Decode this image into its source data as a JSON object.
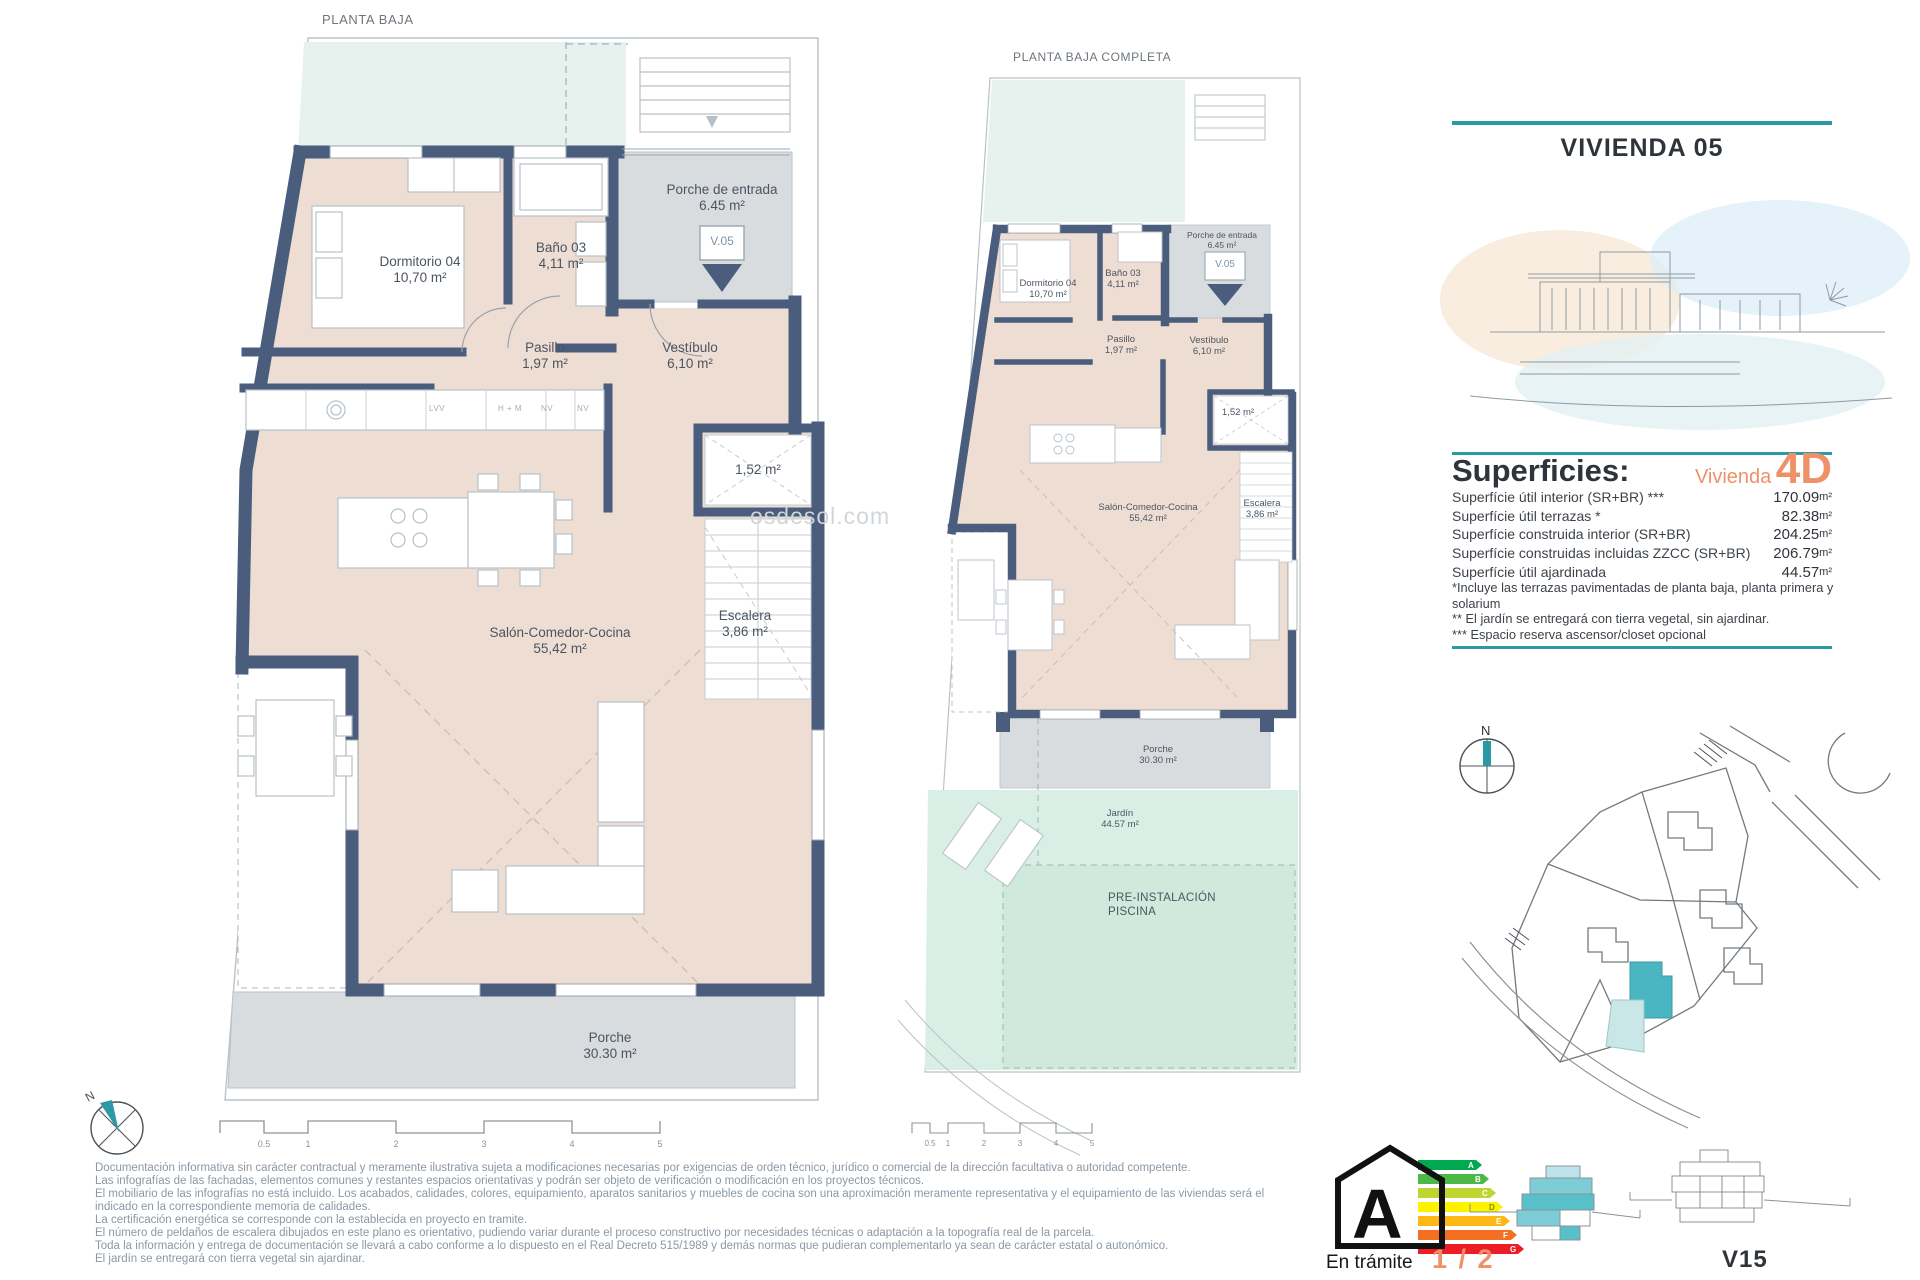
{
  "theme": {
    "accent_teal": "#2b9aa5",
    "accent_orange": "#ef9068",
    "wall": "#4a5d7d",
    "floor": "#eeddd3",
    "terrace": "#e7f2ee",
    "porch": "#d9dcdf",
    "garden": "#d9efe5",
    "garden_deep": "#cfe9dc",
    "line": "#9aa5ad",
    "label": "#4b5560",
    "map_teal": "#49b6c2",
    "map_teal_light": "#c8e7e6"
  },
  "watermark": "osdesol.com",
  "plan_main": {
    "title": "PLANTA BAJA",
    "unit_marker": "V.05",
    "labels": {
      "dormitorio": {
        "name": "Dormitorio 04",
        "area": "10,70 m²"
      },
      "bano": {
        "name": "Baño 03",
        "area": "4,11 m²"
      },
      "porche_entrada": {
        "name": "Porche de entrada",
        "area": "6.45 m²"
      },
      "pasillo": {
        "name": "Pasillo",
        "area": "1,97 m²"
      },
      "vestibulo": {
        "name": "Vestíbulo",
        "area": "6,10 m²"
      },
      "trastero": {
        "area": "1,52 m²"
      },
      "salon": {
        "name": "Salón-Comedor-Cocina",
        "area": "55,42 m²"
      },
      "escalera": {
        "name": "Escalera",
        "area": "3,86 m²"
      },
      "porche": {
        "name": "Porche",
        "area": "30.30 m²"
      }
    },
    "kitchen_labels": [
      "LVV",
      "H + M",
      "NV",
      "NV"
    ]
  },
  "plan_complete": {
    "title": "PLANTA BAJA COMPLETA",
    "unit_marker": "V.05",
    "labels": {
      "dormitorio": {
        "name": "Dormitorio 04",
        "area": "10,70 m²"
      },
      "bano": {
        "name": "Baño 03",
        "area": "4,11 m²"
      },
      "porche_entrada": {
        "name": "Porche de entrada",
        "area": "6.45 m²"
      },
      "pasillo": {
        "name": "Pasillo",
        "area": "1,97 m²"
      },
      "vestibulo": {
        "name": "Vestíbulo",
        "area": "6,10 m²"
      },
      "trastero": {
        "area": "1,52 m²"
      },
      "salon": {
        "name": "Salón-Comedor-Cocina",
        "area": "55,42 m²"
      },
      "escalera": {
        "name": "Escalera",
        "area": "3,86 m²"
      },
      "porche": {
        "name": "Porche",
        "area": "30.30 m²"
      },
      "jardin": {
        "name": "Jardín",
        "area": "44.57 m²"
      },
      "pre_instalacion": {
        "line1": "PRE-INSTALACIÓN",
        "line2": "PISCINA"
      }
    }
  },
  "panel": {
    "title": "VIVIENDA 05",
    "superficies": {
      "heading": "Superficies:",
      "variant_label": "Vivienda",
      "variant_code": "4D",
      "rows": [
        {
          "label": "Superfície útil interior (SR+BR) ***",
          "value": "170.09",
          "unit": "m²"
        },
        {
          "label": "Superfície útil terrazas *",
          "value": "82.38",
          "unit": "m²"
        },
        {
          "label": "Superfície construida interior (SR+BR)",
          "value": "204.25",
          "unit": "m²"
        },
        {
          "label": "Superfície construidas incluidas ZZCC (SR+BR)",
          "value": "206.79",
          "unit": "m²"
        },
        {
          "label": "Superfície útil ajardinada",
          "value": "44.57",
          "unit": "m²"
        }
      ],
      "footnotes": [
        "*Incluye las terrazas pavimentadas de planta baja, planta primera y solarium",
        "** El jardín se entregará con tierra vegetal, sin ajardinar.",
        "*** Espacio reserva ascensor/closet opcional"
      ]
    }
  },
  "site_map": {
    "north_label": "N"
  },
  "footer": {
    "compass_north": "N",
    "scale_ticks": [
      "0.5",
      "1",
      "2",
      "3",
      "4",
      "5"
    ],
    "disclaimer": [
      "Documentación informativa sin carácter contractual y meramente ilustrativa sujeta a modificaciones necesarias por exigencias de orden técnico, jurídico o comercial de la dirección facultativa o autoridad competente.",
      "Las infografías de las fachadas, elementos comunes y restantes espacios orientativas y podrán ser objeto de verificación o modificación en los proyectos técnicos.",
      "El mobiliario de las infografías no está incluido. Los acabados, calidades, colores, equipamiento, aparatos sanitarios y muebles de cocina son una aproximación meramente representativa y el equipamiento de las viviendas será el",
      "indicado en la correspondiente memoria de calidades.",
      "La certificación energética se corresponde con la establecida en proyecto en tramite.",
      "El número de peldaños de escalera dibujados en este plano es orientativo, pudiendo variar durante el proceso constructivo por necesidades técnicas o adaptación a la topografía real de la parcela.",
      "Toda la información y entrega de documentación se llevará a cabo conforme a lo dispuesto en el Real Decreto 515/1989 y demás normas que pudieran complementarlo ya sean de carácter estatal o autonómico.",
      "El jardín se entregará con tierra vegetal sin ajardinar."
    ],
    "energy": {
      "rating": "A",
      "status": "En trámite",
      "bars": [
        {
          "letter": "A",
          "color": "#00a84f"
        },
        {
          "letter": "B",
          "color": "#4cb848"
        },
        {
          "letter": "C",
          "color": "#bed62f"
        },
        {
          "letter": "D",
          "color": "#fef200"
        },
        {
          "letter": "E",
          "color": "#fdb813"
        },
        {
          "letter": "F",
          "color": "#f36f21"
        },
        {
          "letter": "G",
          "color": "#ee1c25"
        }
      ]
    },
    "page_indicator": "1 / 2",
    "sheet_code": "V15"
  }
}
